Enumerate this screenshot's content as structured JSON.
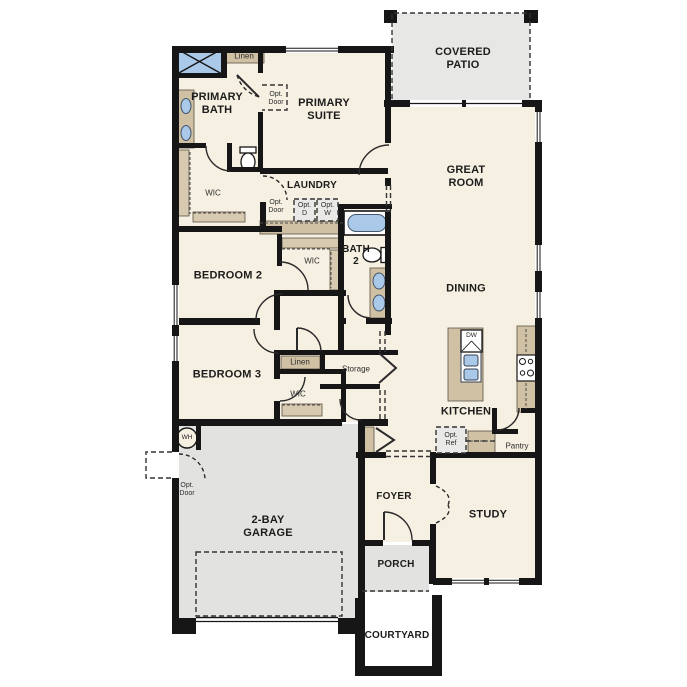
{
  "floor_plan": {
    "rooms": {
      "primary_bath": "PRIMARY\nBATH",
      "primary_suite": "PRIMARY\nSUITE",
      "covered_patio": "COVERED\nPATIO",
      "great_room": "GREAT\nROOM",
      "laundry": "LAUNDRY",
      "bath_2": "BATH\n2",
      "bedroom_2": "BEDROOM 2",
      "dining": "DINING",
      "bedroom_3": "BEDROOM 3",
      "kitchen": "KITCHEN",
      "garage": "2-BAY\nGARAGE",
      "foyer": "FOYER",
      "study": "STUDY",
      "porch": "PORCH",
      "courtyard": "COURTYARD"
    },
    "closets": {
      "linen_upper": "Linen",
      "linen_hall": "Linen",
      "wic_primary": "WIC",
      "wic_bedroom2": "WIC",
      "wic_bedroom3": "WIC",
      "storage": "Storage",
      "pantry": "Pantry"
    },
    "options": {
      "opt_door_primary": "Opt.\nDoor",
      "opt_door_laundry": "Opt.\nDoor",
      "opt_door_garage": "Opt.\nDoor",
      "opt_dryer": "Opt.\nD",
      "opt_washer": "Opt.\nW",
      "opt_refrigerator": "Opt.\nRef"
    },
    "appliances": {
      "dishwasher": "DW",
      "water_heater": "WH"
    },
    "colors": {
      "walls": "#161616",
      "interior_fill": "#f6f0e2",
      "cabinetry_tan": "#d0c1a5",
      "concrete_gray": "#e4e4e2",
      "fixture_blue": "#aac9e8"
    }
  }
}
